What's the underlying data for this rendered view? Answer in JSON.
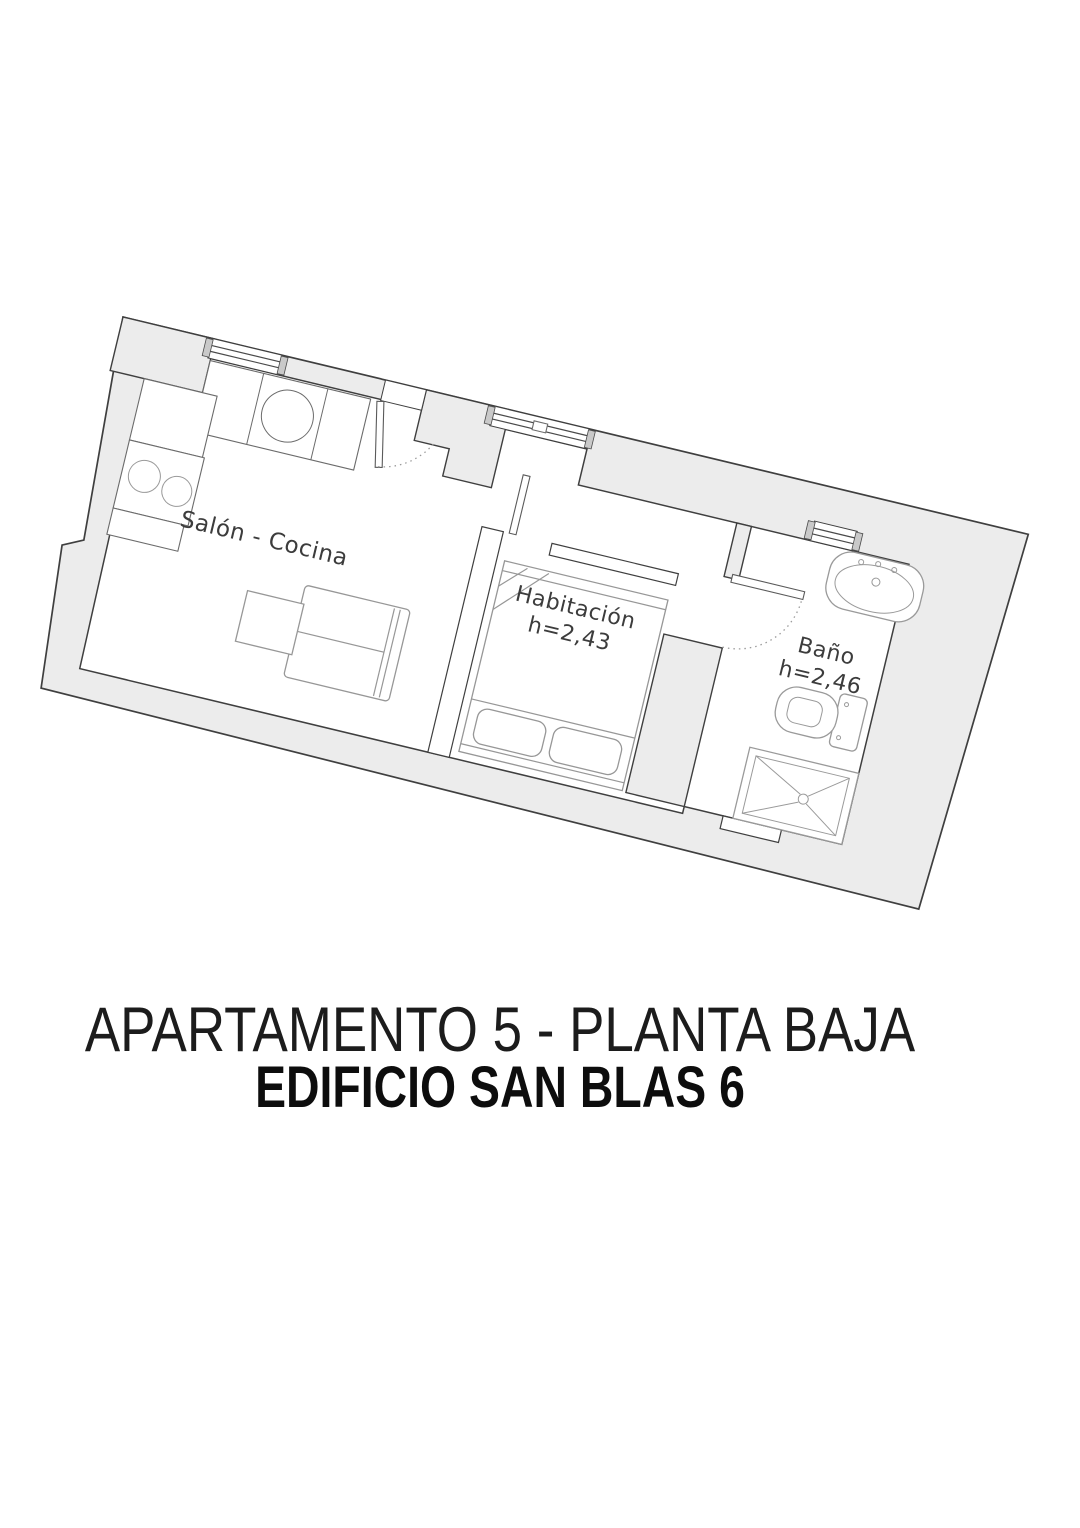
{
  "plan": {
    "rooms": {
      "salon": {
        "label": "Salón - Cocina"
      },
      "habitacion": {
        "label": "Habitación",
        "height": "h=2,43"
      },
      "bano": {
        "label": "Baño",
        "height": "h=2,46"
      }
    },
    "colors": {
      "wall_fill": "#ececec",
      "wall_stroke": "#3f3f3f",
      "furniture_stroke": "#979797",
      "label_text": "#3c3c3c"
    },
    "rotation_deg": 13.5
  },
  "title": {
    "line1": "APARTAMENTO 5 - PLANTA BAJA",
    "line2": "EDIFICIO SAN BLAS 6"
  }
}
